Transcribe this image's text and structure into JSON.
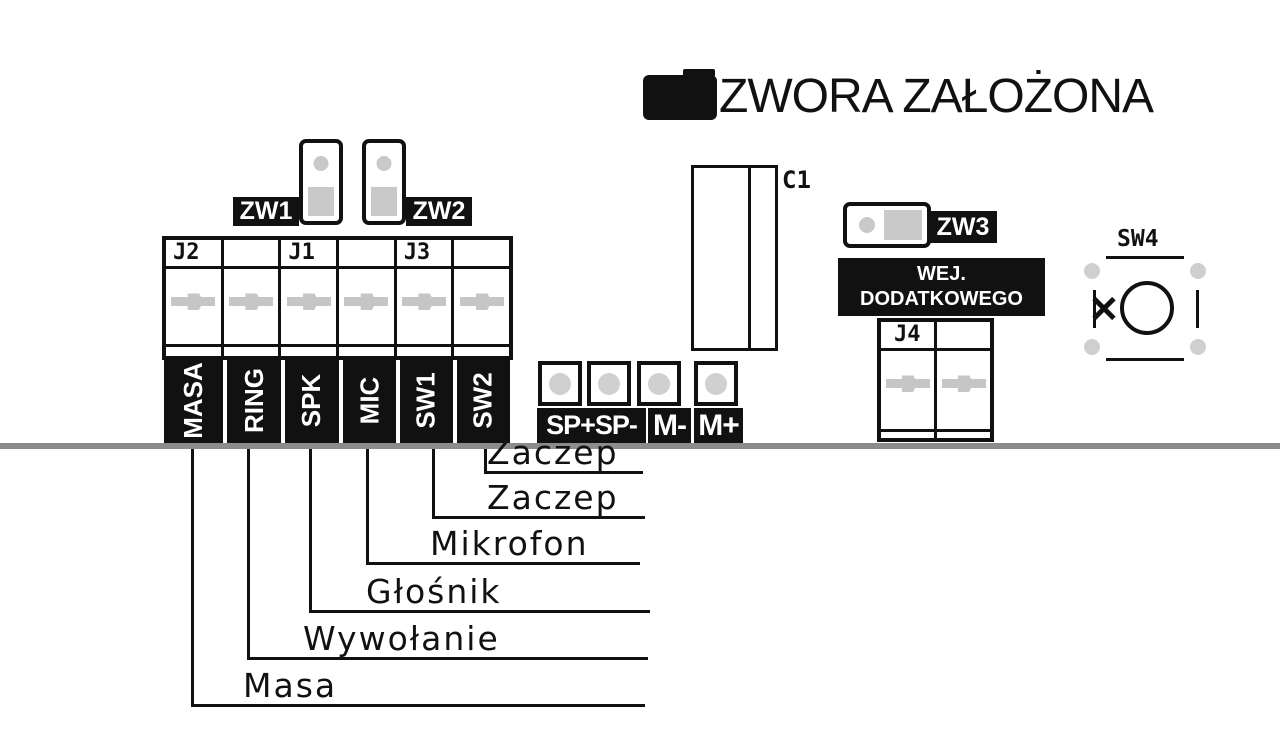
{
  "legend": {
    "label": "ZWORA ZAŁOŻONA"
  },
  "jumpers": {
    "zw1": "ZW1",
    "zw2": "ZW2",
    "zw3": "ZW3"
  },
  "connectors": {
    "j1": "J1",
    "j2": "J2",
    "j3": "J3",
    "j4": "J4"
  },
  "capacitor": {
    "label": "C1"
  },
  "tact_switch": {
    "label": "SW4"
  },
  "aux_input_note": {
    "line1": "WEJ. DODATKOWEGO",
    "line2": "PRZYCISKU"
  },
  "terminals": [
    {
      "pin": "MASA",
      "signal": "Masa"
    },
    {
      "pin": "RING",
      "signal": "Wywołanie"
    },
    {
      "pin": "SPK",
      "signal": "Głośnik"
    },
    {
      "pin": "MIC",
      "signal": "Mikrofon"
    },
    {
      "pin": "SW1",
      "signal": "Zaczep"
    },
    {
      "pin": "SW2",
      "signal": "Zaczep"
    }
  ],
  "solder_pads": [
    "SP+",
    "SP-",
    "M-",
    "M+"
  ],
  "colors": {
    "ink": "#111111",
    "pad_gray": "#c9c9c9",
    "board_edge": "#8c8c8c"
  }
}
